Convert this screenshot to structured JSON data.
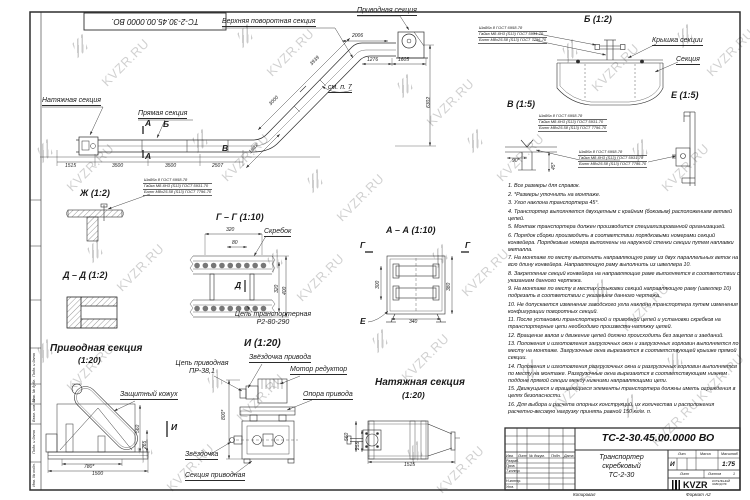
{
  "watermark": {
    "text": "KVZR.RU",
    "positions": [
      [
        95,
        55
      ],
      [
        260,
        45
      ],
      [
        420,
        95
      ],
      [
        585,
        60
      ],
      [
        700,
        45
      ],
      [
        60,
        160
      ],
      [
        215,
        150
      ],
      [
        330,
        190
      ],
      [
        490,
        150
      ],
      [
        655,
        160
      ],
      [
        110,
        260
      ],
      [
        290,
        270
      ],
      [
        455,
        265
      ],
      [
        615,
        300
      ],
      [
        60,
        360
      ],
      [
        230,
        390
      ],
      [
        395,
        350
      ],
      [
        545,
        380
      ],
      [
        690,
        370
      ],
      [
        160,
        460
      ],
      [
        430,
        462
      ],
      [
        645,
        415
      ]
    ]
  },
  "frame": {
    "top_code": "ТС-2-30.45.00.0000 ВО.",
    "side_labels": [
      "Подп. и дата",
      "Инв. № дубл.",
      "Взам. инв. №",
      "Подп. и дата",
      "Инв. № подл."
    ]
  },
  "spec_block": {
    "l1": "Шайба 8 ГОСТ 6958-78",
    "l2": "Гайка М8-6Н3 (S13) ГОСТ 5931-70",
    "l3": "Болт М8х25.58 (S13) ГОСТ 7796-70"
  },
  "main_view": {
    "labels": {
      "upper_turn": "Верхняя поворотная секция",
      "drive": "Приводная секция",
      "tension": "Натяжная секция",
      "straight": "Прямая секция",
      "see_note": "см. п. 7"
    },
    "marks": {
      "a_top": "А",
      "a_bot": "А",
      "b": "Б",
      "v": "В"
    },
    "dims": {
      "top": "2006",
      "t1": "1276",
      "t2": "1605",
      "diag_upper": "3939",
      "diag_lower": "3000",
      "height": "6302",
      "bend": "1847",
      "c1": "1515",
      "c2": "3500",
      "c3": "3500",
      "c4": "2507"
    }
  },
  "details": {
    "b": {
      "title": "Б (1:2)",
      "cover": "Крышка секции",
      "section": "Секция"
    },
    "v": {
      "title": "В (1:5)",
      "dim1": "90*",
      "dim2": "45*"
    },
    "e": {
      "title": "Е (1:5)"
    },
    "zh": {
      "title": "Ж (1:2)"
    },
    "dd": {
      "title": "Д – Д (1:2)"
    },
    "gg": {
      "title": "Г – Г (1:10)",
      "scraper": "Скребок",
      "chain1": "Цепь транспортерная",
      "chain2": "Р2-80-290",
      "d_mark": "Д",
      "dims": {
        "w": "320",
        "w2": "80",
        "h1": "320",
        "h2": "400"
      }
    },
    "aa": {
      "title": "А – А (1:10)",
      "g_mark": "Г",
      "e_mark": "Е",
      "dims": {
        "left": "300",
        "right": "380",
        "bottom": "340"
      }
    }
  },
  "drive_view": {
    "title": "Приводная секция",
    "scale": "(1:20)",
    "casing": "Защитный кожух",
    "i_mark": "И",
    "dims": {
      "h1": "560",
      "h2": "265",
      "w1": "780*",
      "w2": "1500"
    }
  },
  "i_view": {
    "title": "И (1:20)",
    "chain1": "Цепь приводная",
    "chain2": "ПР-38,1",
    "sprocket_drive": "Звёздочка привода",
    "motor": "Мотор редуктор",
    "support": "Опора привода",
    "sprocket": "Звёздочка",
    "section": "Секция приводная",
    "dim_h": "800*"
  },
  "tension_view": {
    "title": "Натяжная секция",
    "scale": "(1:20)",
    "dims": {
      "w": "1515",
      "h1": "560",
      "h2": "255"
    }
  },
  "notes": [
    "1. Все размеры для справок.",
    "2. *Размеры уточнить на монтаже.",
    "3. Угол наклона транспортера 45°.",
    "4. Транспортер выполняется двухцепным с крайним (боковым) расположением ветвей цепей.",
    "5. Монтаж транспортера должен производится специализированной организацией.",
    "6. Порядок сборки производить в соответствии порядковыми номерами секций конвейера. Порядковые номера выполнены на наружной стенки секции путем наплавки металла.",
    "7. На монтаже по месту выполнить направляющую раму из двух параллельных веток на всю длину конвейера. Направляющую раму выполнить из швеллера 10.",
    "8. Закрепление секций конвейера на направляющие раме выполняется в соответствии с указанием данного чертежа.",
    "9. На монтаже по месту в местах стыковки секций направляющую раму (швеллер 10) подрезать в соответствии с указанием данного чертежа.",
    "10. Не допускается изменение заводского угла наклона транспортера путем изменения конфигурации поворотных секций.",
    "11. После установки транспортерной и приводной цепей и установки скребков на транспортерные цепи необходимо произвести натяжку цепей.",
    "12. Вращение валов и движение цепей должно происходить без зацепов и заеданий.",
    "13. Положения и изготовления загрузочных окон и загрузочных горловин выполняется по месту на монтаже. Загрузочные окна вырезаются в соответствующей крышке прямой секции.",
    "14. Положения и изготовления разгрузочных окна и разгрузочных горловин выполняется по месту на монтаже. Разгрузочные окна вырезаются в соответствующем нижнем поддоне прямой секции между нижними направляющими цепи.",
    "15. Движущиеся и вращающиеся элементы транспортера должны иметь ограждения в целях безопасности.",
    "16. Для выбора и расчета опорных конструкций, их количества и расположения расчетно-весовую нагрузку принять равной 150 кг/м. п."
  ],
  "titleblock": {
    "code": "ТС-2-30.45.00.0000 ВО",
    "name1": "Транспортер",
    "name2": "скребковый",
    "name3": "ТС-2-30",
    "lit_header": "Лит.",
    "mass_header": "Масса",
    "scale_header": "Масштаб",
    "lit": "И",
    "scale": "1:75",
    "sheet_label": "Лист",
    "sheets_label": "Листов",
    "sheets_value": "1",
    "cols": [
      "Изм.",
      "Лист",
      "№ докум.",
      "Подп.",
      "Дата"
    ],
    "rows": [
      "Разраб.",
      "Пров.",
      "Т.контр.",
      "Н.контр.",
      "Утв."
    ],
    "logo_word": "KVZR",
    "logo_sub1": "КОТЕЛЬНЫЙ",
    "logo_sub2": "ЗАВОД РФ",
    "copied": "Копировал",
    "format": "Формат А2"
  }
}
